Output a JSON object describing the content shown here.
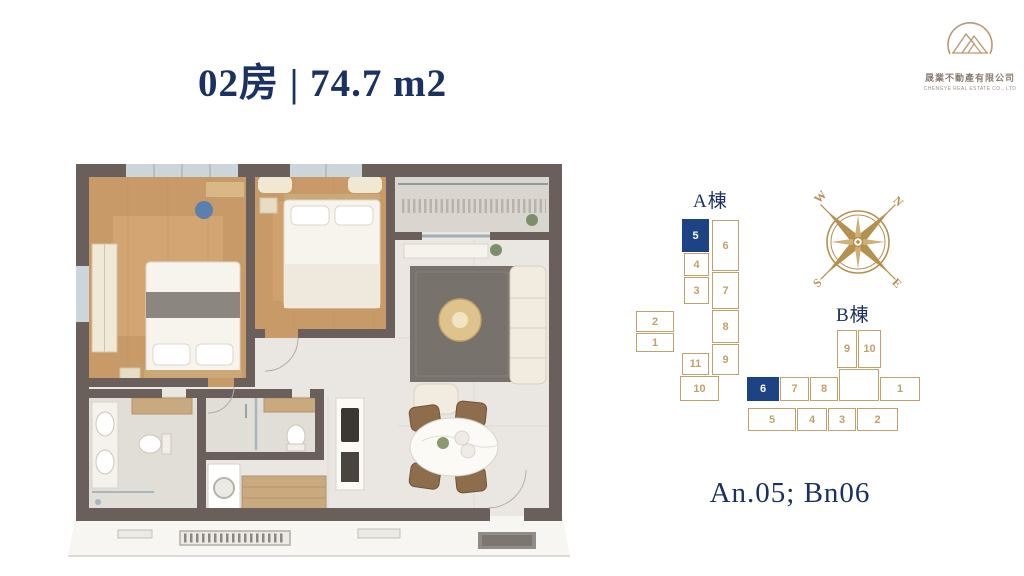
{
  "title": "02房 | 74.7 m2",
  "logo": {
    "company_zh": "晟業不動產有限公司",
    "company_en": "CHENGYE REAL ESTATE CO., LTD"
  },
  "buildings": {
    "a": {
      "label": "A棟",
      "highlighted_unit": "5",
      "units": [
        {
          "label": "5",
          "x": 52,
          "y": 33,
          "w": 27,
          "h": 33,
          "highlighted": true
        },
        {
          "label": "4",
          "x": 54,
          "y": 67,
          "w": 25,
          "h": 23,
          "highlighted": false
        },
        {
          "label": "3",
          "x": 54,
          "y": 91,
          "w": 25,
          "h": 27,
          "highlighted": false
        },
        {
          "label": "2",
          "x": 6,
          "y": 125,
          "w": 38,
          "h": 21,
          "highlighted": false
        },
        {
          "label": "1",
          "x": 6,
          "y": 147,
          "w": 38,
          "h": 19,
          "highlighted": false
        },
        {
          "label": "11",
          "x": 52,
          "y": 167,
          "w": 27,
          "h": 22,
          "highlighted": false
        },
        {
          "label": "10",
          "x": 50,
          "y": 190,
          "w": 39,
          "h": 25,
          "highlighted": false
        },
        {
          "label": "6",
          "x": 82,
          "y": 34,
          "w": 27,
          "h": 51,
          "highlighted": false
        },
        {
          "label": "7",
          "x": 82,
          "y": 86,
          "w": 27,
          "h": 37,
          "highlighted": false
        },
        {
          "label": "8",
          "x": 82,
          "y": 124,
          "w": 27,
          "h": 33,
          "highlighted": false
        },
        {
          "label": "9",
          "x": 82,
          "y": 158,
          "w": 27,
          "h": 31,
          "highlighted": false
        }
      ]
    },
    "b": {
      "label": "B棟",
      "highlighted_unit": "6",
      "units": [
        {
          "label": "9",
          "x": 97,
          "y": 30,
          "w": 20,
          "h": 38,
          "highlighted": false
        },
        {
          "label": "10",
          "x": 118,
          "y": 30,
          "w": 23,
          "h": 38,
          "highlighted": false
        },
        {
          "label": "6",
          "x": 7,
          "y": 77,
          "w": 32,
          "h": 24,
          "highlighted": true
        },
        {
          "label": "7",
          "x": 40,
          "y": 77,
          "w": 29,
          "h": 24,
          "highlighted": false
        },
        {
          "label": "8",
          "x": 70,
          "y": 77,
          "w": 28,
          "h": 24,
          "highlighted": false
        },
        {
          "label": "",
          "x": 99,
          "y": 69,
          "w": 40,
          "h": 32,
          "highlighted": false
        },
        {
          "label": "1",
          "x": 140,
          "y": 77,
          "w": 40,
          "h": 24,
          "highlighted": false
        },
        {
          "label": "5",
          "x": 8,
          "y": 108,
          "w": 48,
          "h": 23,
          "highlighted": false
        },
        {
          "label": "4",
          "x": 57,
          "y": 108,
          "w": 30,
          "h": 23,
          "highlighted": false
        },
        {
          "label": "3",
          "x": 88,
          "y": 108,
          "w": 28,
          "h": 23,
          "highlighted": false
        },
        {
          "label": "2",
          "x": 117,
          "y": 108,
          "w": 41,
          "h": 23,
          "highlighted": false
        }
      ]
    }
  },
  "compass": {
    "n": "N",
    "e": "E",
    "s": "S",
    "w": "W"
  },
  "footer_code": "An.05; Bn06",
  "colors": {
    "navy": "#1b3161",
    "gold_outline": "#c2a06b",
    "compass_gold": "#b5904f",
    "unit_highlight": "#1d4384",
    "wall": "#6b5f5b",
    "wood_floor": "#c89a68"
  }
}
